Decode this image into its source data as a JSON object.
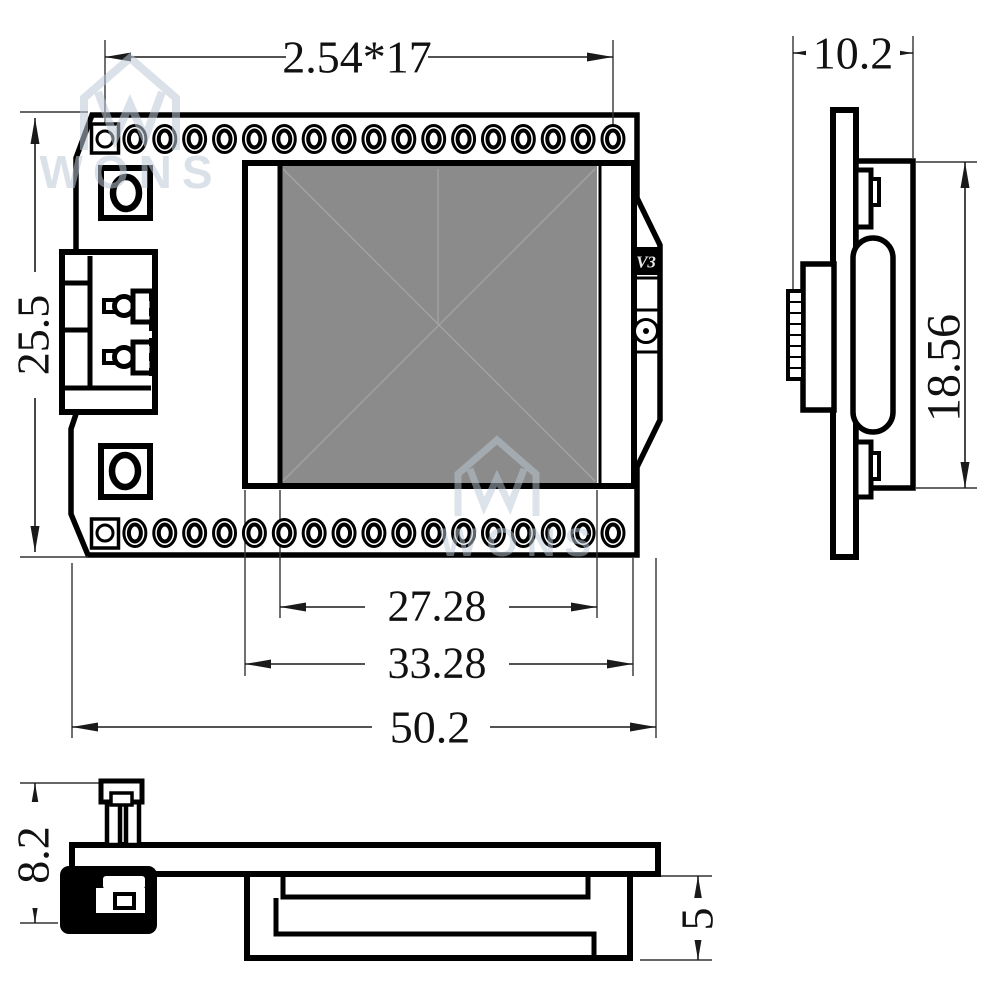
{
  "drawing": {
    "type": "mechanical-dimension-drawing",
    "subject": "ESP32 OLED development board outline drawing, three views",
    "board_label": "V3",
    "watermark_text": "WONS",
    "colors": {
      "line": "#000000",
      "display_fill": "#8b8b8b",
      "crease": "#a4a4a4",
      "watermark": "#bcc9d6",
      "dim_text": "#111111"
    },
    "dimensions": {
      "pin_pitch": "2.54*17",
      "board_height": "25.5",
      "active_width": "27.28",
      "display_width": "33.28",
      "board_width": "50.2",
      "side_width": "10.2",
      "module_height": "18.56",
      "assembly_height": "8.2",
      "display_thickness": "5"
    },
    "pins": {
      "per_row": 18,
      "rows": 2,
      "start_x": 105,
      "end_x": 613,
      "top_cy": 139,
      "bottom_cy": 533
    }
  }
}
